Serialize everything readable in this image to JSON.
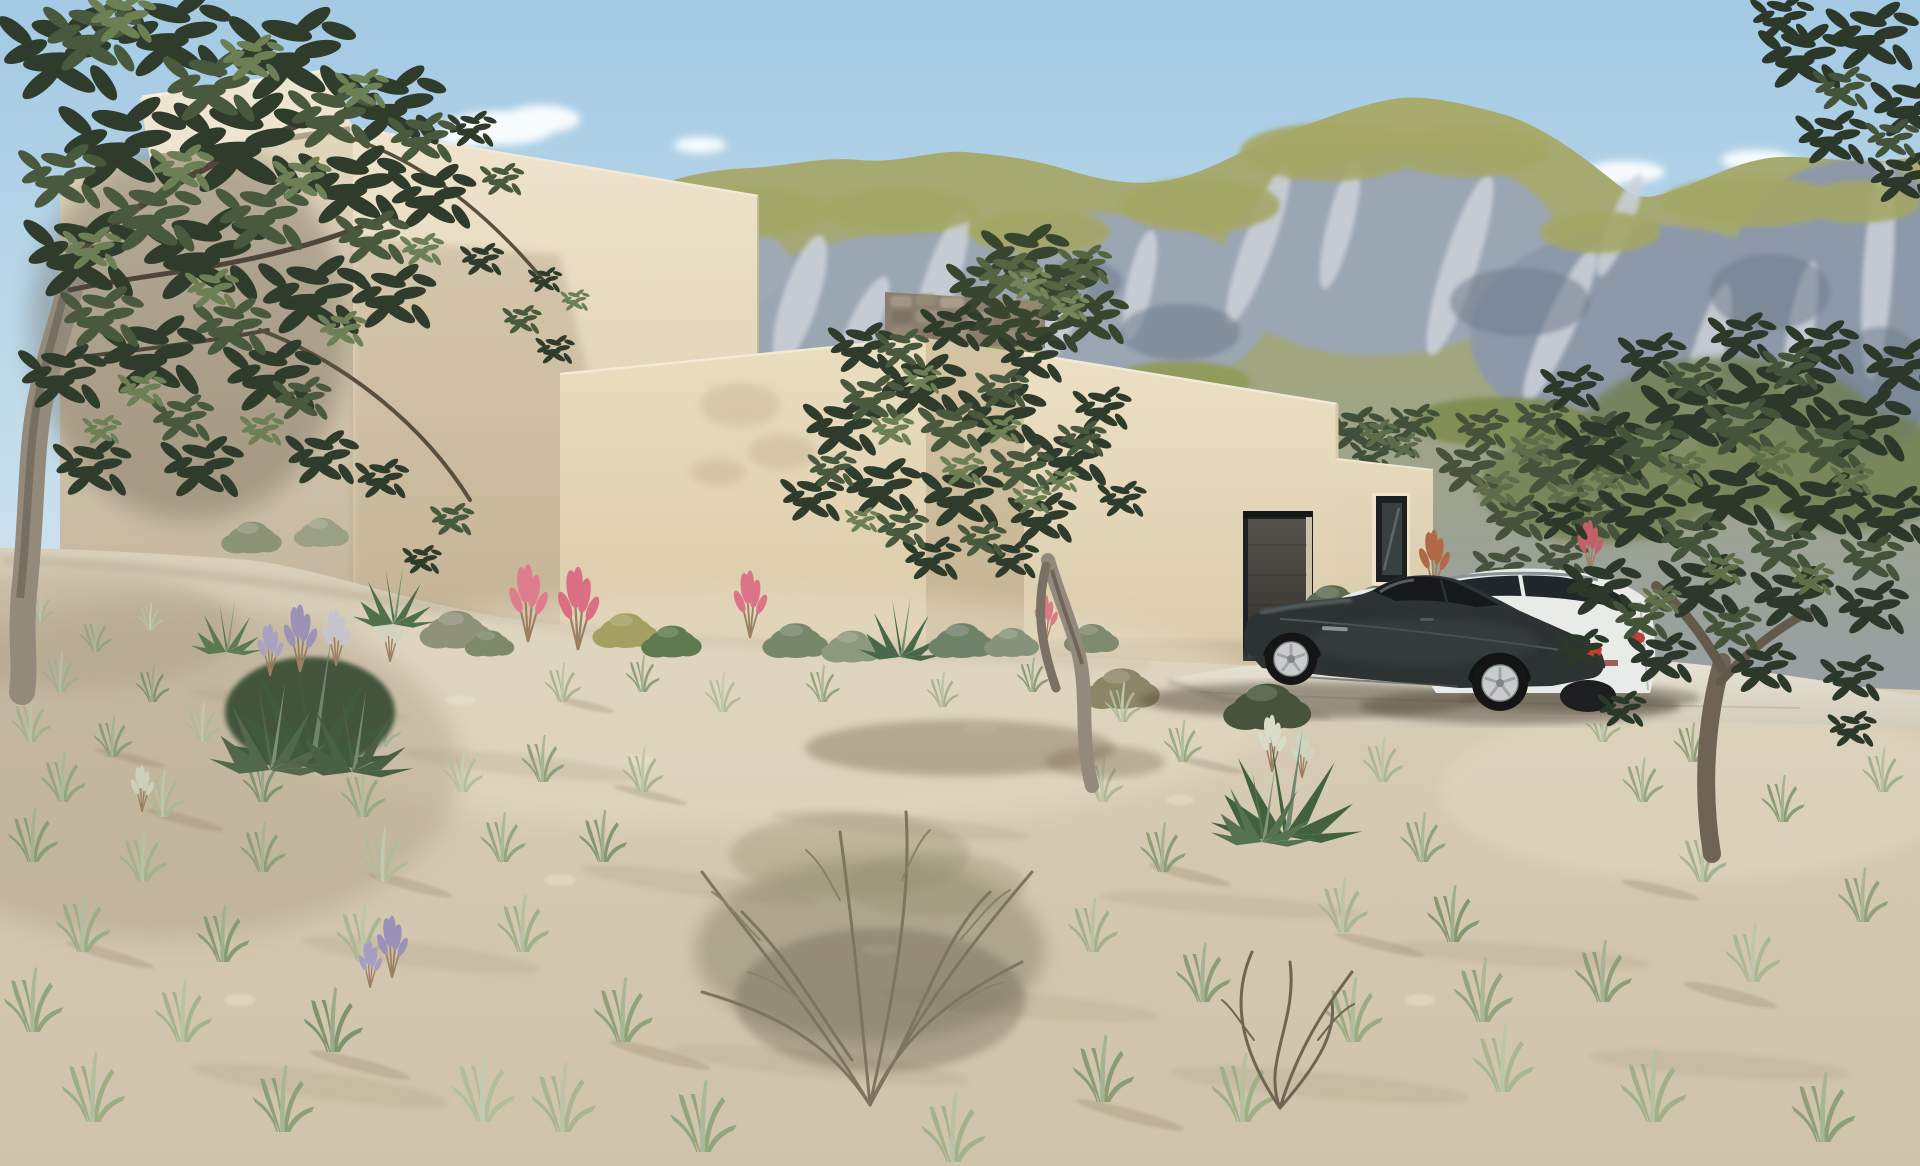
{
  "meta": {
    "title": "Architectural rendering - modern desert villa with olive trees",
    "width_px": 1920,
    "height_px": 1166
  },
  "scene": {
    "setting": "arid hillside plot with wild grasses, olive trees and a rocky green mountain ridge behind",
    "sky": {
      "condition": "clear with small white clouds",
      "cloud_count": 6
    },
    "house": {
      "style": "flat-roofed stacked modern volumes",
      "material": "beige stucco",
      "features": [
        "overhanging parapet cap",
        "stepped rooflines",
        "rubble stone wall",
        "dark recessed garage opening",
        "tall narrow dark-framed window",
        "rooftop olive shrubs"
      ]
    },
    "vehicles": [
      {
        "label": "black luxury sports coupe",
        "position": "foreground driveway"
      },
      {
        "label": "white sedan",
        "position": "behind coupe, partly hidden"
      },
      {
        "label": "silver estate car",
        "position": "right of driveway, behind trees"
      }
    ],
    "vegetation": [
      "large olive tree left",
      "olive tree centre",
      "olive tree right",
      "pink plume flowers",
      "agave and yucca rosettes",
      "grey-green shrubs",
      "dry twiggy bush",
      "scattered pale grass tufts",
      "lavender spikes"
    ]
  },
  "palette": {
    "sky_top": "#a3c9e4",
    "sky_mid": "#c2dcea",
    "sky_horizon": "#dbe8ef",
    "cloud": "#f7fbfd",
    "mountain_grass": "#a9ab6c",
    "mountain_mid": "#a2a67c",
    "mountain_rock_base": "#97a0a6",
    "mountain_rock": "#9ba6b3",
    "mountain_rock_light": "#cdd3da",
    "mountain_rock_shadow": "#6e7c8a",
    "mountain_green_dark": "#6f7f4e",
    "wall_cap": "#eee5d0",
    "wall_light": "#efe4cc",
    "wall_mid": "#d5c5a6",
    "wall_dark": "#c2b08f",
    "stone_wall": "#8a7e6e",
    "door_dark": "#1f2224",
    "door_panel": "#56524c",
    "window_frame": "#1d2022",
    "window_glass": "#384140",
    "sand_light": "#d9cfba",
    "sand_dark": "#cfc3ab",
    "sand_shadow": "#a3937a",
    "pavement": "#e7e2d3",
    "foliage_dark": "#2f3b2b",
    "foliage_mid": "#49593d",
    "foliage_light": "#6d7f55",
    "trunk": "#938a7b",
    "grass_pale": "#b3bd9c",
    "grass_green": "#8da07a",
    "dry_bush": "#7d7560",
    "flower_pink": "#dc7487",
    "flower_rust": "#b06a45",
    "lavender": "#9a90b8",
    "car_black": "#2d3233",
    "car_black_highlight": "#5e686a",
    "car_white": "#e9ebe9",
    "car_window": "#15191b",
    "wheel_silver": "#c9cccd",
    "taillight_red": "#c23f31"
  }
}
